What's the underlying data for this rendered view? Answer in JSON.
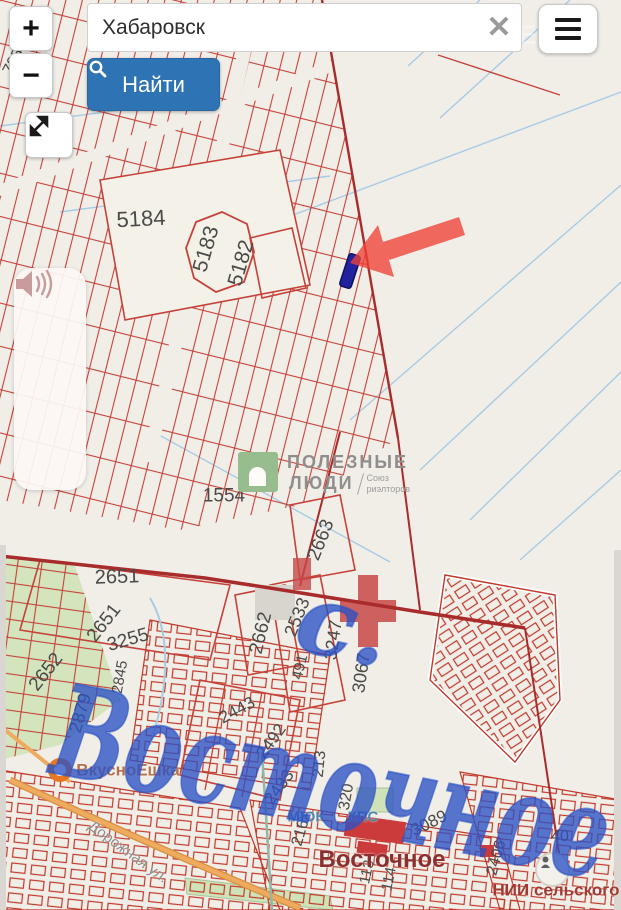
{
  "ui": {
    "zoom_in_label": "+",
    "zoom_out_label": "−",
    "search": {
      "value": "Хабаровск",
      "clear_icon": "✕"
    },
    "find_button_label": "Найти"
  },
  "watermarks": {
    "site_mark": "ONREALT",
    "agency_line1": "ПОЛЕЗНЫЕ",
    "agency_line2": "ЛЮДИ",
    "agency_sub_line1": "Союз",
    "agency_sub_line2": "риэлторов"
  },
  "handwriting": {
    "prefix": "с.",
    "text": "Восточное"
  },
  "map": {
    "parcel_labels": [
      {
        "t": "785",
        "x": 14,
        "y": 62,
        "r": -62,
        "s": 16
      },
      {
        "t": "5184",
        "x": 141,
        "y": 219,
        "r": -3,
        "s": 22
      },
      {
        "t": "5183",
        "x": 206,
        "y": 249,
        "r": -74,
        "s": 21
      },
      {
        "t": "5182",
        "x": 241,
        "y": 263,
        "r": -74,
        "s": 21
      },
      {
        "t": "1554",
        "x": 224,
        "y": 496,
        "r": 0,
        "s": 19
      },
      {
        "t": "2663",
        "x": 321,
        "y": 540,
        "r": -68,
        "s": 19
      },
      {
        "t": "2651",
        "x": 117,
        "y": 577,
        "r": -2,
        "s": 20
      },
      {
        "t": "2651",
        "x": 104,
        "y": 623,
        "r": -52,
        "s": 19
      },
      {
        "t": "3255",
        "x": 128,
        "y": 640,
        "r": -16,
        "s": 19
      },
      {
        "t": "2662",
        "x": 261,
        "y": 633,
        "r": -76,
        "s": 19
      },
      {
        "t": "2533",
        "x": 297,
        "y": 617,
        "r": -68,
        "s": 18
      },
      {
        "t": "3247",
        "x": 333,
        "y": 640,
        "r": -82,
        "s": 18
      },
      {
        "t": "3067",
        "x": 361,
        "y": 673,
        "r": -82,
        "s": 18
      },
      {
        "t": "2652",
        "x": 46,
        "y": 672,
        "r": -52,
        "s": 19
      },
      {
        "t": "2879",
        "x": 80,
        "y": 713,
        "r": -74,
        "s": 18
      },
      {
        "t": "2845",
        "x": 120,
        "y": 677,
        "r": -80,
        "s": 15
      },
      {
        "t": "491",
        "x": 300,
        "y": 667,
        "r": -76,
        "s": 15
      },
      {
        "t": "2443",
        "x": 237,
        "y": 710,
        "r": -28,
        "s": 17
      },
      {
        "t": "2492",
        "x": 271,
        "y": 741,
        "r": -54,
        "s": 17
      },
      {
        "t": "2433",
        "x": 279,
        "y": 787,
        "r": -54,
        "s": 17
      },
      {
        "t": "213",
        "x": 320,
        "y": 764,
        "r": -84,
        "s": 16
      },
      {
        "t": "216",
        "x": 301,
        "y": 833,
        "r": -74,
        "s": 16
      },
      {
        "t": "320",
        "x": 347,
        "y": 797,
        "r": -80,
        "s": 16
      },
      {
        "t": "3089",
        "x": 429,
        "y": 823,
        "r": -26,
        "s": 17
      },
      {
        "t": "113",
        "x": 367,
        "y": 872,
        "r": -78,
        "s": 15
      },
      {
        "t": "114",
        "x": 389,
        "y": 879,
        "r": -78,
        "s": 15
      },
      {
        "t": "2406",
        "x": 497,
        "y": 858,
        "r": -74,
        "s": 16
      },
      {
        "t": "40",
        "x": 560,
        "y": 837,
        "r": 0,
        "s": 16
      }
    ],
    "poi_labels": [
      {
        "t": "ВкусноЕшка",
        "x": 128,
        "y": 770,
        "r": 0,
        "s": 17,
        "c": "#b5714a",
        "w": "700"
      },
      {
        "t": "МЮК",
        "x": 306,
        "y": 817,
        "r": 0,
        "s": 15,
        "c": "#4e86a8",
        "w": "700"
      },
      {
        "t": "КПС",
        "x": 363,
        "y": 817,
        "r": 0,
        "s": 15,
        "c": "#4e86a8",
        "w": "700"
      },
      {
        "t": "Восточное",
        "x": 382,
        "y": 860,
        "r": 0,
        "s": 24,
        "c": "#8a3030",
        "w": "600"
      },
      {
        "t": "НИИ сельского",
        "x": 556,
        "y": 890,
        "r": 0,
        "s": 17,
        "c": "#a03a35",
        "w": "700"
      },
      {
        "t": "Дорожная ул.",
        "x": 128,
        "y": 852,
        "r": 36,
        "s": 15,
        "c": "#8f8d8a",
        "w": "400"
      }
    ]
  },
  "colors": {
    "parcel_line": "#c5423a",
    "boundary_line": "#a82c2c",
    "water_line": "#a8cbe4",
    "arrow": "#ef4136",
    "selected_parcel": "#22229f",
    "handwriting_blue": "#2b52c4",
    "find_button": "#2e74b5",
    "park_green": "#d4e4bd",
    "road_orange": "#eeab5f"
  }
}
